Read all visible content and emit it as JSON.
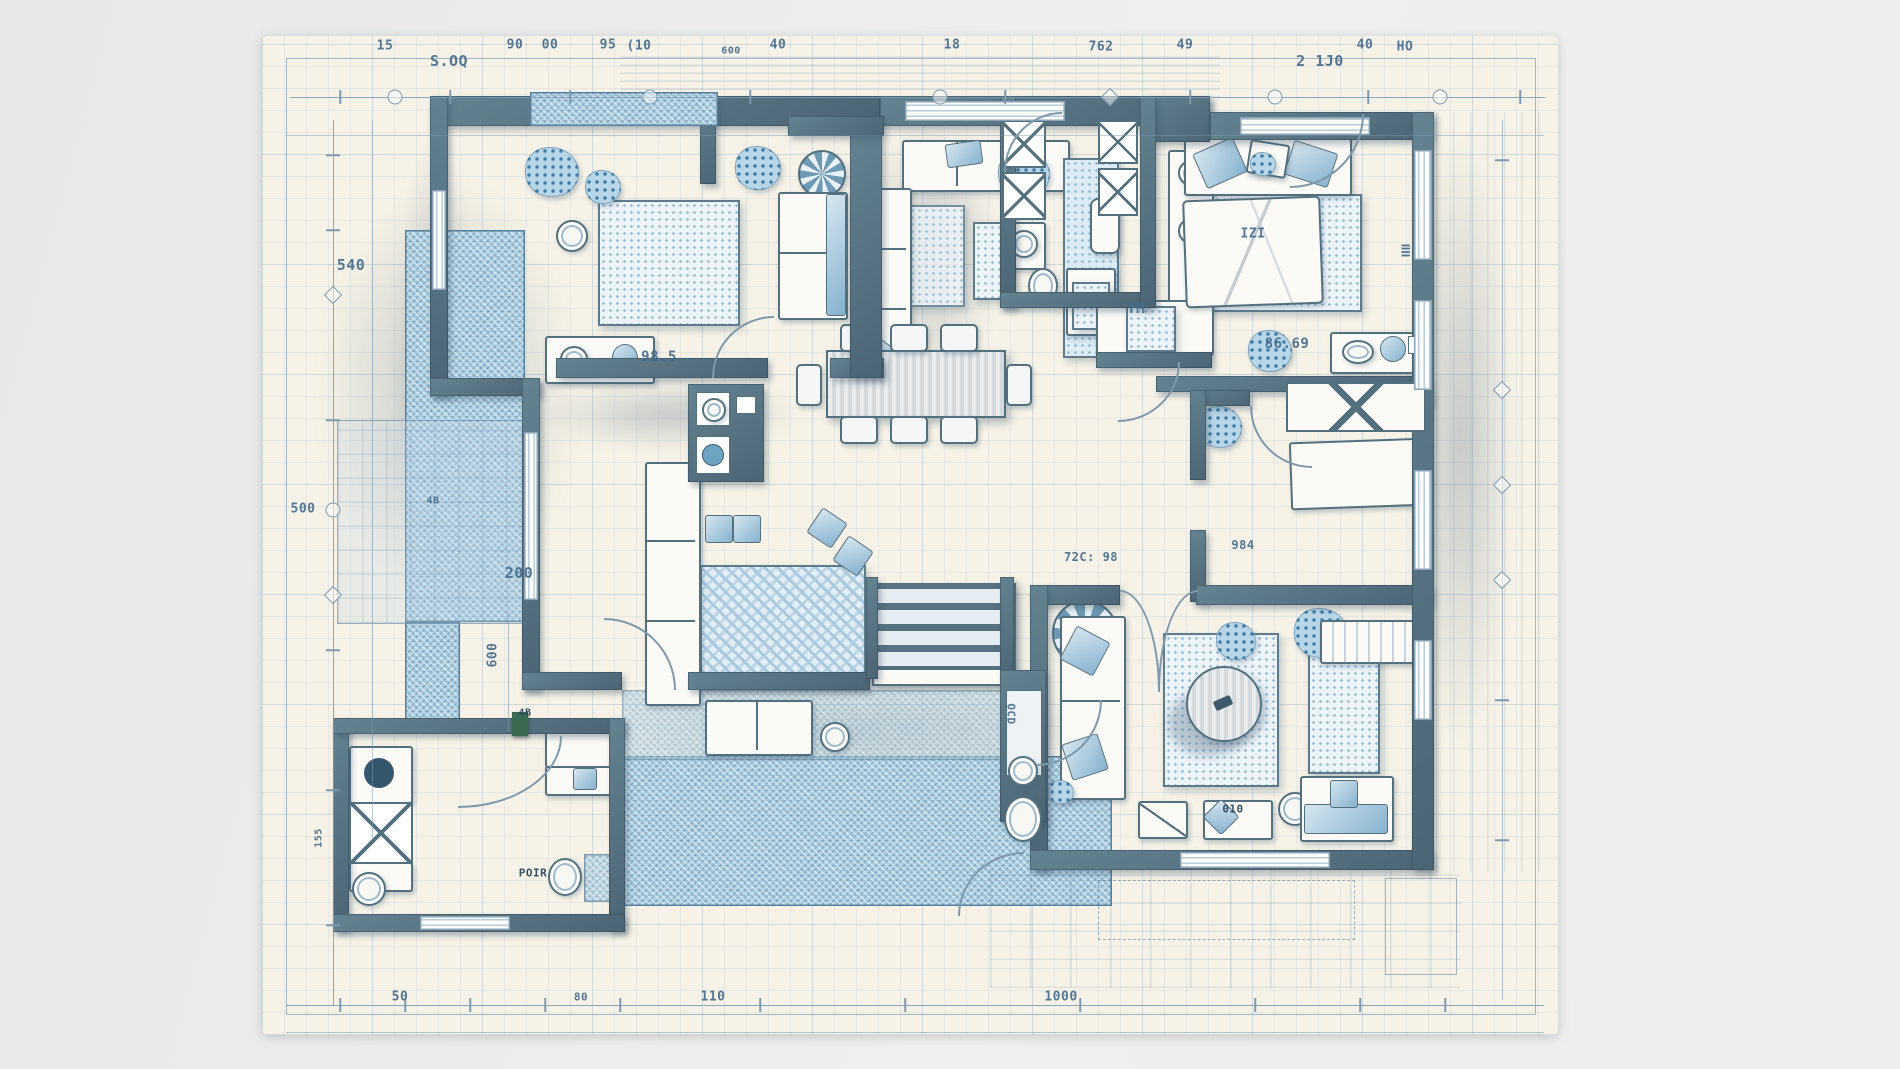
{
  "document_type": "architectural-floor-plan-blueprint",
  "palette": {
    "background": "#eceded",
    "paper": "#f6f2e7",
    "wall": "#57727f",
    "ink": "#456c8c",
    "hatch_blue": "#aed0e2",
    "rug_dot_blue": "#97bed7",
    "furniture_fill": "#fbfaf6"
  },
  "labels": [
    {
      "text": "15"
    },
    {
      "text": "S.OQ"
    },
    {
      "text": "90"
    },
    {
      "text": "00"
    },
    {
      "text": "95"
    },
    {
      "text": "(10"
    },
    {
      "text": "600"
    },
    {
      "text": "40"
    },
    {
      "text": "18"
    },
    {
      "text": "762"
    },
    {
      "text": "49"
    },
    {
      "text": "2 1J0"
    },
    {
      "text": "40"
    },
    {
      "text": "HO"
    },
    {
      "text": "540"
    },
    {
      "text": "500"
    },
    {
      "text": "4B"
    },
    {
      "text": "200"
    },
    {
      "text": "600"
    },
    {
      "text": "155"
    },
    {
      "text": "98.5"
    },
    {
      "text": "YM"
    },
    {
      "text": "IZI"
    },
    {
      "text": "≣"
    },
    {
      "text": "86.69"
    },
    {
      "text": "72C: 98"
    },
    {
      "text": "984"
    },
    {
      "text": "OCD"
    },
    {
      "text": "POIR"
    },
    {
      "text": "010"
    },
    {
      "text": "4B"
    },
    {
      "text": "50"
    },
    {
      "text": "80"
    },
    {
      "text": "110"
    },
    {
      "text": "1000"
    }
  ]
}
